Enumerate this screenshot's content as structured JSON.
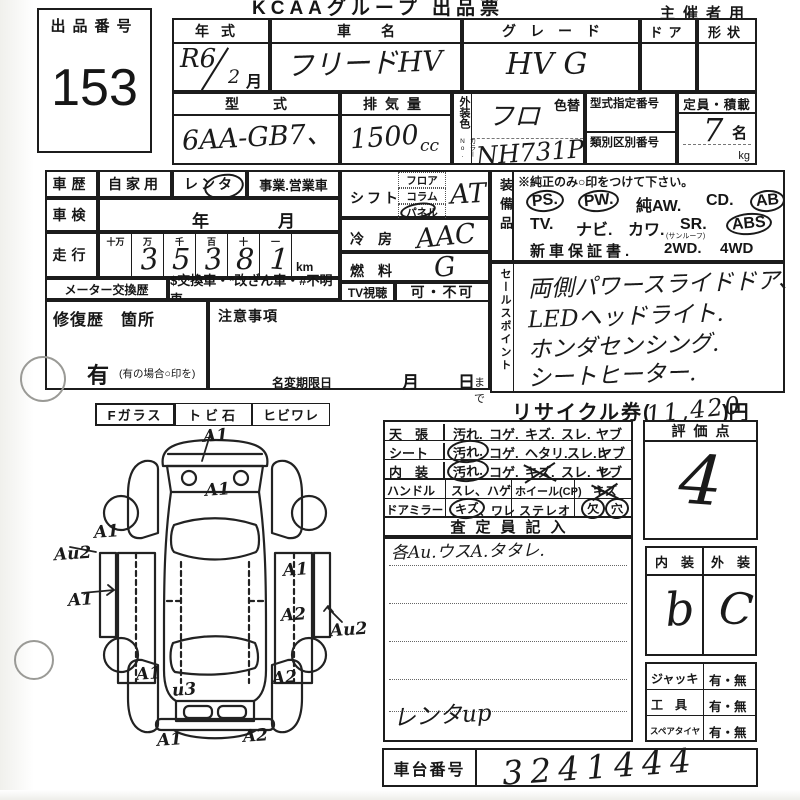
{
  "page": {
    "title": "KCAAグループ 出品票",
    "audience": "主催者用"
  },
  "lot": {
    "label": "出品番号",
    "number": "153"
  },
  "head": {
    "year_label": "年式",
    "year_value": "R6",
    "year_month": "2",
    "month_unit": "月",
    "name_label": "車名",
    "name_value": "フリードHV",
    "grade_label": "グレード",
    "grade_value": "HV G",
    "door_label": "ドア",
    "shape_label": "形状",
    "model_label": "型式",
    "model_value": "6AA-GB7、",
    "disp_label": "排気量",
    "disp_value": "1500",
    "disp_unit": "cc",
    "color_label": "外装色",
    "color_no_label": "カラーNo.",
    "color_alt_label": "色替",
    "color_value": "フロ",
    "color_code": "NH731P",
    "type_no_label": "型式指定番号",
    "class_no_label": "類別区別番号",
    "capacity_label": "定員・積載",
    "capacity_value": "7",
    "capacity_unit": "名",
    "weight_unit": "kg"
  },
  "history": {
    "label": "車歴",
    "private": "自家用",
    "rental": "レンタ",
    "business": "事業.営業車",
    "inspection_label": "車検",
    "inspection_year": "年",
    "inspection_month": "月",
    "mileage_label": "走行",
    "digit_headers": [
      "十万",
      "万",
      "千",
      "百",
      "十",
      "一"
    ],
    "digits": [
      "",
      "3",
      "5",
      "3",
      "8",
      "1"
    ],
    "km": "km",
    "meter_label": "メーター交換歴",
    "meter_options": "$交換車・*改ざん車・#不明車",
    "repair_label": "修復歴　箇所",
    "repair_yes": "有",
    "repair_note": "(有の場合○印を)",
    "caution_label": "注意事項",
    "name_change_label": "名変期限日",
    "month": "月",
    "day_until": "日",
    "until": "まで"
  },
  "drive": {
    "shift_label": "シフト",
    "shift_options": [
      "フロア",
      "コラム",
      "パネル"
    ],
    "shift_value": "AT、",
    "ac_label": "冷　房",
    "ac_value": "AAC",
    "fuel_label": "燃　料",
    "fuel_value": "G",
    "tv_label": "TV視聴",
    "tv_value": "可・不可"
  },
  "equipment": {
    "label": "装備品",
    "note": "※純正のみ○印をつけて下さい。",
    "row1": [
      "PS.",
      "PW.",
      "純AW.",
      "CD.",
      "AB"
    ],
    "row2": [
      "TV.",
      "ナビ.",
      "カワ.",
      "SR.",
      "ABS"
    ],
    "sr_note": "(サンルーフ)",
    "row3": [
      "新車保証書.",
      "2WD.",
      "4WD"
    ],
    "circled": [
      "PS",
      "PW",
      "AB",
      "ABS"
    ]
  },
  "sales": {
    "label": "セールスポイント",
    "lines": [
      "両側パワースライドドア、",
      "LEDヘッドライト.",
      "ホンダセンシング.",
      "シートヒーター."
    ]
  },
  "recycle": {
    "prefix": "リサイクル券(",
    "value": "11,420",
    "suffix": ")円"
  },
  "condition": {
    "rows": [
      {
        "name": "天　張",
        "opts": [
          "汚れ.",
          "コゲ.",
          "キズ.",
          "スレ.",
          "ヤブレ"
        ]
      },
      {
        "name": "シート",
        "opts": [
          "汚れ.",
          "コゲ.",
          "ヘタリ.",
          "スレ.",
          "ヤブレ"
        ]
      },
      {
        "name": "内　装",
        "opts": [
          "汚れ.",
          "コゲ.",
          "キズ.",
          "スレ.",
          "ヤブレ"
        ]
      }
    ],
    "handle_label": "ハンドル",
    "handle_opts": "スレ、ハゲ",
    "wheel_label": "ホイール(CP)",
    "wheel_value": "キズ",
    "mirror_label": "ドアミラー",
    "mirror_opt1": "キズ",
    "mirror_opt2": "、ワレ",
    "stereo_label": "ステレオ",
    "stereo_value1": "欠",
    "stereo_value2": "穴",
    "circled": [
      "汚れ(シート)",
      "汚れ(内装)",
      "キズ(ドアミラー)",
      "欠",
      "穴"
    ],
    "header": "査定員記入",
    "inspector_note": "各Au.ウスA.タタレ.",
    "inspector_note2": "レンタup"
  },
  "score": {
    "label": "評価点",
    "value": "4",
    "interior_label": "内　装",
    "exterior_label": "外　装",
    "interior_value": "b",
    "exterior_value": "C"
  },
  "tools": {
    "rows": [
      {
        "label": "ジャッキ",
        "value": "有・無"
      },
      {
        "label": "工　具",
        "value": "有・無"
      },
      {
        "label": "スペアタイヤ",
        "value": "有・無"
      }
    ]
  },
  "chassis": {
    "label": "車台番号",
    "value": "3241444"
  },
  "glass": {
    "cells": [
      "Fガラス",
      "トビ石",
      "ヒビワレ"
    ]
  },
  "diagram": {
    "labels": [
      {
        "t": "A1",
        "x": 203,
        "y": 426
      },
      {
        "t": "A1",
        "x": 205,
        "y": 480
      },
      {
        "t": "A1",
        "x": 94,
        "y": 522
      },
      {
        "t": "Au2",
        "x": 54,
        "y": 544
      },
      {
        "t": "A1",
        "x": 68,
        "y": 590
      },
      {
        "t": "A1",
        "x": 283,
        "y": 560
      },
      {
        "t": "A2",
        "x": 281,
        "y": 605
      },
      {
        "t": "Au2",
        "x": 330,
        "y": 620
      },
      {
        "t": "A1",
        "x": 136,
        "y": 664
      },
      {
        "t": "A2",
        "x": 272,
        "y": 668
      },
      {
        "t": "u3",
        "x": 172,
        "y": 680
      },
      {
        "t": "A1",
        "x": 157,
        "y": 730
      },
      {
        "t": "A2",
        "x": 243,
        "y": 726
      }
    ]
  }
}
